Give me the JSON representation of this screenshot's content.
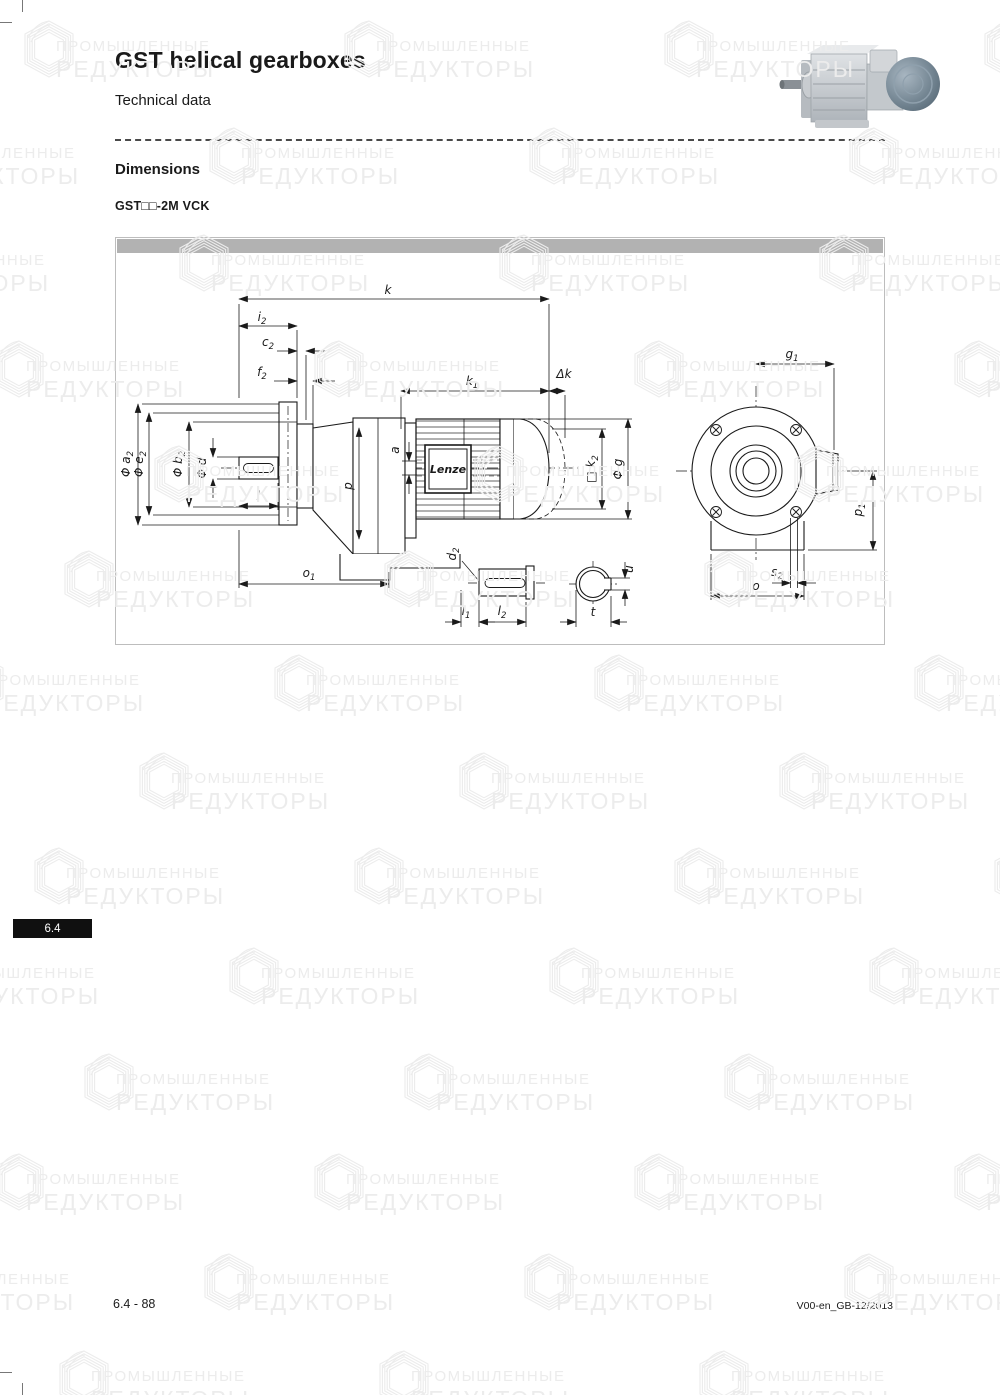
{
  "page": {
    "title": "GST helical gearboxes",
    "subtitle": "Technical data",
    "section_heading": "Dimensions",
    "variant_label": "GST□□-2M VCK",
    "tab_label": "6.4",
    "footer_left": "6.4 - 88",
    "footer_right": "V00-en_GB-12/2013"
  },
  "watermark": {
    "line1": "ПРОМЫШЛЕННЫЕ",
    "line2": "РЕДУКТОРЫ"
  },
  "figure": {
    "brand": "Lenze",
    "labels": {
      "k": {
        "base": "k",
        "sub": ""
      },
      "i2": {
        "base": "i",
        "sub": "2"
      },
      "c2": {
        "base": "c",
        "sub": "2"
      },
      "f2": {
        "base": "f",
        "sub": "2"
      },
      "k1": {
        "base": "k",
        "sub": "1"
      },
      "dk": {
        "base": "Δk",
        "sub": ""
      },
      "a2": {
        "base": "Φ a",
        "sub": "2"
      },
      "e2": {
        "base": "Φ e",
        "sub": "2"
      },
      "b2": {
        "base": "Φ b",
        "sub": "2"
      },
      "d": {
        "base": "Φ d",
        "sub": ""
      },
      "l": {
        "base": "l",
        "sub": ""
      },
      "o1": {
        "base": "o",
        "sub": "1"
      },
      "a": {
        "base": "a",
        "sub": ""
      },
      "p": {
        "base": "p",
        "sub": ""
      },
      "k2": {
        "base": "□ k",
        "sub": "2"
      },
      "g": {
        "base": "Φ g",
        "sub": ""
      },
      "g1": {
        "base": "g",
        "sub": "1"
      },
      "p1": {
        "base": "p",
        "sub": "1"
      },
      "s2": {
        "base": "s",
        "sub": "2"
      },
      "o": {
        "base": "o",
        "sub": ""
      },
      "d2": {
        "base": "d",
        "sub": "2"
      },
      "l1": {
        "base": "l",
        "sub": "1"
      },
      "l2": {
        "base": "l",
        "sub": "2"
      },
      "t": {
        "base": "t",
        "sub": ""
      },
      "u": {
        "base": "u",
        "sub": ""
      }
    }
  }
}
